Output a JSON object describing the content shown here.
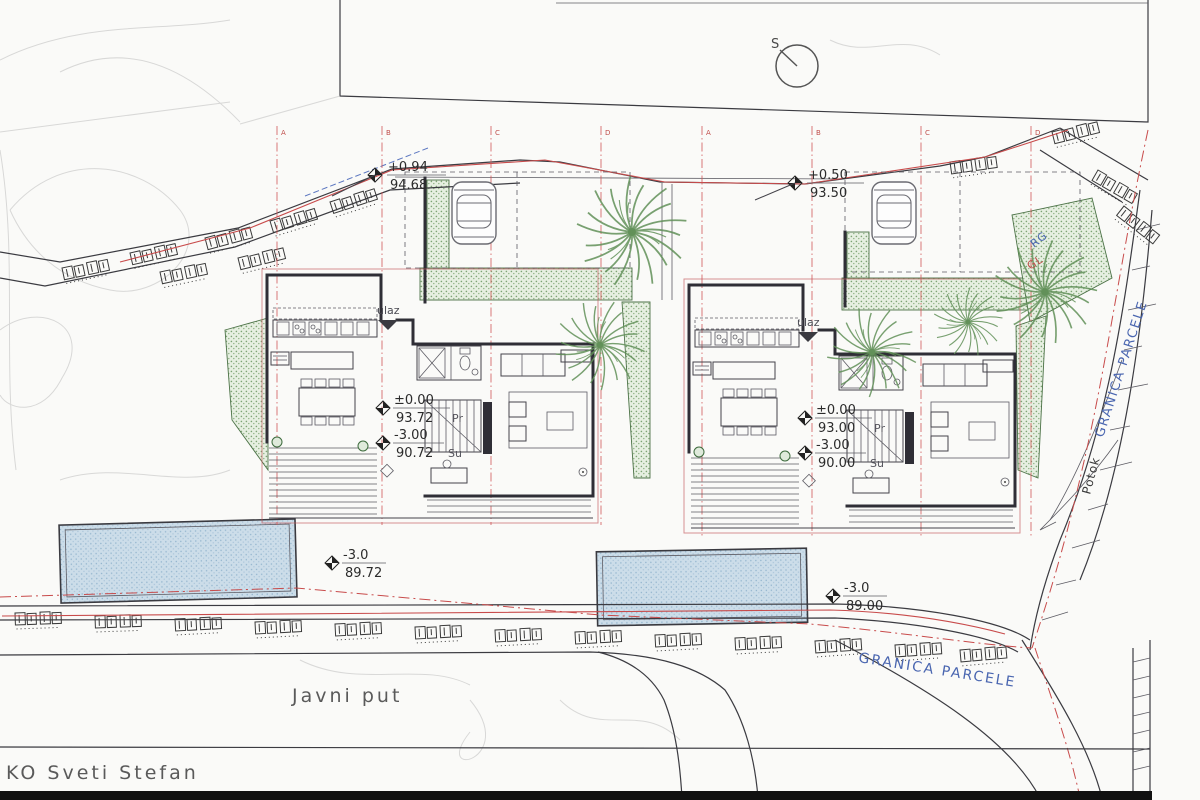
{
  "document": {
    "type": "scanned architectural site plan"
  },
  "compass": {
    "label": "S"
  },
  "grid": {
    "labels": [
      "A",
      "B",
      "C",
      "D"
    ]
  },
  "levels": {
    "street_left": {
      "rel": "+0.94",
      "abs": "94.68"
    },
    "street_right": {
      "rel": "+0.50",
      "abs": "93.50"
    },
    "villa_left_ground": {
      "rel": "±0.00",
      "abs": "93.72"
    },
    "villa_left_lower": {
      "rel": "-3.00",
      "abs": "90.72"
    },
    "villa_right_ground": {
      "rel": "±0.00",
      "abs": "93.00"
    },
    "villa_right_lower": {
      "rel": "-3.00",
      "abs": "90.00"
    },
    "pool_left": {
      "rel": "-3.0",
      "abs": "89.72"
    },
    "pool_right": {
      "rel": "-3.0",
      "abs": "89.00"
    }
  },
  "labels": {
    "entrance": "ulaz",
    "floor_ground": "Pr",
    "floor_basement": "Su",
    "parcel_boundary_right": "GRANICA PARCELE",
    "parcel_boundary_bottom": "GRANICA PARCELE",
    "rg_mark": "RG",
    "gl_mark": "GL",
    "stream": "Potok",
    "public_road": "Javni put",
    "cadastre": "KO Sveti Stefan"
  },
  "colors": {
    "boundary_red": "#c84b4b",
    "annotation_blue": "#4a66b0",
    "wall_dark": "#2f2e36",
    "vegetation_green": "#7da374",
    "pool_blue": "#ccdde9"
  }
}
